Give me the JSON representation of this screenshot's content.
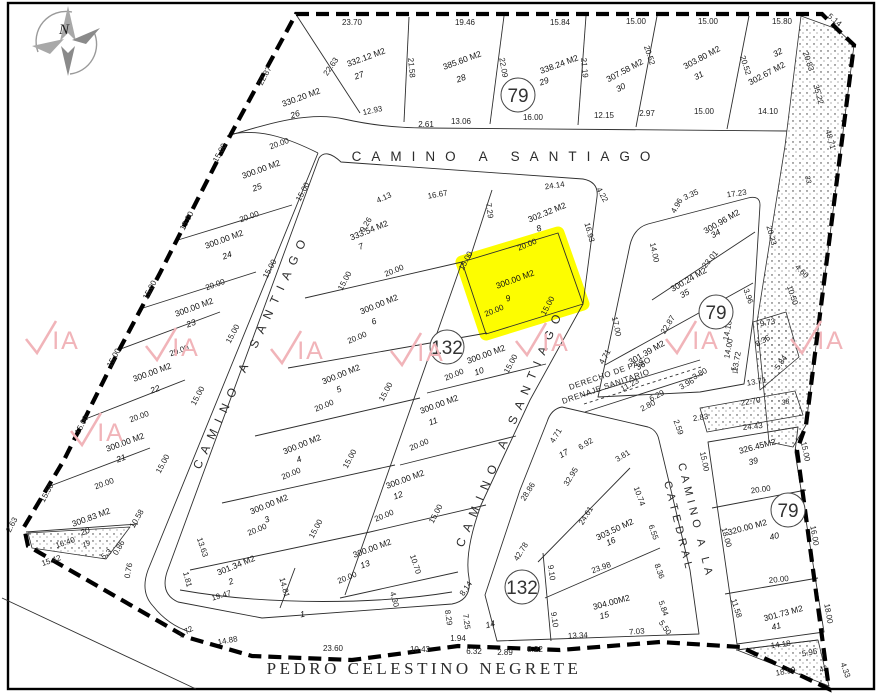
{
  "map": {
    "compass": {
      "label": "N"
    },
    "highlight": {
      "lot": "9",
      "color": "#fdfd00"
    },
    "watermark": {
      "text": "IA",
      "color": "#f1b4b9",
      "positions": [
        [
          50,
          345
        ],
        [
          170,
          352
        ],
        [
          295,
          355
        ],
        [
          415,
          357
        ],
        [
          540,
          347
        ],
        [
          690,
          345
        ],
        [
          815,
          345
        ],
        [
          95,
          437
        ]
      ]
    },
    "streets": [
      {
        "label": "CAMINO A SANTIAGO",
        "x": 506,
        "y": 161,
        "rot": 0,
        "fs": 13.5,
        "ls": 10,
        "anchor": "middle",
        "serif": false
      },
      {
        "label": "CAMINO A SANTIAGO",
        "x": 200,
        "y": 470,
        "rot": -65,
        "fs": 12,
        "ls": 8,
        "anchor": "start",
        "serif": false
      },
      {
        "label": "CAMINO A SANTIAGO",
        "x": 463,
        "y": 548,
        "rot": -67,
        "fs": 12,
        "ls": 8,
        "anchor": "start",
        "serif": false
      },
      {
        "label": "CAMINO A LA",
        "x": 678,
        "y": 464,
        "rot": 76,
        "fs": 11,
        "ls": 4.5,
        "anchor": "start",
        "serif": false
      },
      {
        "label": "CATEDRAL",
        "x": 664,
        "y": 482,
        "rot": 76,
        "fs": 11,
        "ls": 4.5,
        "anchor": "start",
        "serif": false
      },
      {
        "label": "PEDRO CELESTINO NEGRETE",
        "x": 424,
        "y": 674,
        "rot": 0,
        "fs": 17,
        "ls": 3.5,
        "anchor": "middle",
        "serif": true
      }
    ],
    "easement": {
      "line1": "DERECHO DE PASO",
      "line2": "DRENAJE SANITARIO",
      "x": 570,
      "y": 390,
      "x2": 563,
      "y2": 404,
      "rot": -19
    },
    "circles": [
      {
        "label": "79",
        "x": 518,
        "y": 95
      },
      {
        "label": "79",
        "x": 716,
        "y": 312
      },
      {
        "label": "79",
        "x": 788,
        "y": 510
      },
      {
        "label": "132",
        "x": 447,
        "y": 347
      },
      {
        "label": "132",
        "x": 522,
        "y": 587
      }
    ],
    "lots": [
      {
        "n": "26",
        "a": "330.20 M2",
        "ax": 302,
        "ay": 100,
        "nx": 296,
        "ny": 117,
        "r": -20
      },
      {
        "n": "27",
        "a": "332.12 M2",
        "ax": 367,
        "ay": 60,
        "nx": 360,
        "ny": 78,
        "r": -20
      },
      {
        "n": "28",
        "a": "385.60 M2",
        "ax": 463,
        "ay": 63,
        "nx": 462,
        "ny": 81,
        "r": -20
      },
      {
        "n": "29",
        "a": "338.24 M2",
        "ax": 560,
        "ay": 67,
        "nx": 545,
        "ny": 84,
        "r": -20
      },
      {
        "n": "30",
        "a": "307.58 M2",
        "ax": 626,
        "ay": 73,
        "nx": 622,
        "ny": 90,
        "r": -28
      },
      {
        "n": "31",
        "a": "303.80 M2",
        "ax": 703,
        "ay": 60,
        "nx": 700,
        "ny": 78,
        "r": -28
      },
      {
        "n": "32",
        "a": "302.67 M2",
        "ax": 768,
        "ay": 76,
        "nx": 779,
        "ny": 55,
        "r": -28
      },
      {
        "n": "25",
        "a": "300.00 M2",
        "ax": 262,
        "ay": 172,
        "nx": 258,
        "ny": 190,
        "r": -20
      },
      {
        "n": "24",
        "a": "300.00 M2",
        "ax": 225,
        "ay": 242,
        "nx": 228,
        "ny": 258,
        "r": -20
      },
      {
        "n": "23",
        "a": "300.00 M2",
        "ax": 195,
        "ay": 310,
        "nx": 192,
        "ny": 326,
        "r": -20
      },
      {
        "n": "22",
        "a": "300.00 M2",
        "ax": 153,
        "ay": 375,
        "nx": 156,
        "ny": 392,
        "r": -20
      },
      {
        "n": "21",
        "a": "300.00 M2",
        "ax": 126,
        "ay": 445,
        "nx": 122,
        "ny": 461,
        "r": -20
      },
      {
        "n": "20",
        "a": "300.83 M2",
        "ax": 92,
        "ay": 520,
        "nx": 86,
        "ny": 534,
        "r": -20
      },
      {
        "n": "7",
        "a": "333.54 M2",
        "ax": 370,
        "ay": 233,
        "nx": 362,
        "ny": 249,
        "r": -22
      },
      {
        "n": "8",
        "a": "302.32 M2",
        "ax": 548,
        "ay": 215,
        "nx": 540,
        "ny": 231,
        "r": -22
      },
      {
        "n": "9",
        "a": "300.00 M2",
        "ax": 516,
        "ay": 282,
        "nx": 509,
        "ny": 301,
        "r": -20
      },
      {
        "n": "6",
        "a": "300.00 M2",
        "ax": 380,
        "ay": 307,
        "nx": 375,
        "ny": 324,
        "r": -22
      },
      {
        "n": "5",
        "a": "300.00 M2",
        "ax": 342,
        "ay": 377,
        "nx": 340,
        "ny": 392,
        "r": -22
      },
      {
        "n": "4",
        "a": "300.00 M2",
        "ax": 303,
        "ay": 447,
        "nx": 300,
        "ny": 462,
        "r": -22
      },
      {
        "n": "3",
        "a": "300.00 M2",
        "ax": 270,
        "ay": 507,
        "nx": 268,
        "ny": 522,
        "r": -22
      },
      {
        "n": "2",
        "a": "301.34 M2",
        "ax": 237,
        "ay": 568,
        "nx": 232,
        "ny": 584,
        "r": -22
      },
      {
        "n": "1",
        "a": null,
        "nx": 303,
        "ny": 617,
        "r": -10
      },
      {
        "n": "10",
        "a": "300.00 M2",
        "ax": 487,
        "ay": 357,
        "nx": 480,
        "ny": 374,
        "r": -20
      },
      {
        "n": "11",
        "a": "300.00 M2",
        "ax": 440,
        "ay": 407,
        "nx": 434,
        "ny": 424,
        "r": -20
      },
      {
        "n": "12",
        "a": "300.00 M2",
        "ax": 406,
        "ay": 482,
        "nx": 399,
        "ny": 498,
        "r": -20
      },
      {
        "n": "13",
        "a": "300.00 M2",
        "ax": 373,
        "ay": 551,
        "nx": 366,
        "ny": 567,
        "r": -20
      },
      {
        "n": "14",
        "a": null,
        "nx": 491,
        "ny": 627,
        "r": -15
      },
      {
        "n": "15",
        "a": "304.00M2",
        "ax": 612,
        "ay": 605,
        "nx": 605,
        "ny": 618,
        "r": -15
      },
      {
        "n": "16",
        "a": "303.50 M2",
        "ax": 616,
        "ay": 532,
        "nx": 612,
        "ny": 544,
        "r": -25
      },
      {
        "n": "17",
        "a": null,
        "nx": 565,
        "ny": 456,
        "r": -30
      },
      {
        "n": "34",
        "a": "300.96 M2",
        "ax": 723,
        "ay": 224,
        "nx": 717,
        "ny": 236,
        "r": -30
      },
      {
        "n": "35",
        "a": "300.24 M2",
        "ax": 690,
        "ay": 282,
        "nx": 686,
        "ny": 296,
        "r": -30
      },
      {
        "n": "36",
        "a": "301.39 M2",
        "ax": 648,
        "ay": 355,
        "nx": 642,
        "ny": 368,
        "r": -30
      },
      {
        "n": "39",
        "a": "326.45M2",
        "ax": 758,
        "ay": 449,
        "nx": 754,
        "ny": 464,
        "r": -15
      },
      {
        "n": "40",
        "a": "320.00 M2",
        "ax": 748,
        "ay": 530,
        "nx": 775,
        "ny": 539,
        "r": -15
      },
      {
        "n": "41",
        "a": "301.73 M2",
        "ax": 784,
        "ay": 616,
        "nx": 777,
        "ny": 629,
        "r": -15
      },
      {
        "n": "33",
        "a": null,
        "nx": 806,
        "ny": 180,
        "r": 75,
        "s": 1
      },
      {
        "n": "37",
        "a": null,
        "nx": 732,
        "ny": 371,
        "r": 70,
        "s": 1
      },
      {
        "n": "38",
        "a": null,
        "nx": 786,
        "ny": 404,
        "r": -15,
        "s": 1
      },
      {
        "n": "42",
        "a": null,
        "nx": 824,
        "ny": 671,
        "r": -20,
        "s": 1
      },
      {
        "n": "19",
        "a": null,
        "nx": 87,
        "ny": 546,
        "r": -20,
        "s": 1
      }
    ],
    "dims": [
      [
        "23.70",
        352,
        25,
        0
      ],
      [
        "19.46",
        465,
        25,
        0
      ],
      [
        "15.84",
        560,
        25,
        0
      ],
      [
        "15.00",
        636,
        24,
        0
      ],
      [
        "15.00",
        708,
        24,
        0
      ],
      [
        "15.80",
        782,
        24,
        0
      ],
      [
        "5.14",
        833,
        22,
        40
      ],
      [
        "22.87",
        267,
        77,
        -62
      ],
      [
        "22.63",
        333,
        68,
        -55
      ],
      [
        "21.58",
        409,
        68,
        85
      ],
      [
        "22.09",
        501,
        68,
        80
      ],
      [
        "21.19",
        582,
        68,
        85
      ],
      [
        "20.52",
        647,
        56,
        72
      ],
      [
        "20.52",
        743,
        66,
        72
      ],
      [
        "20.83",
        806,
        62,
        72
      ],
      [
        "35.22",
        816,
        95,
        75
      ],
      [
        "48.71",
        828,
        140,
        75
      ],
      [
        "12.93",
        373,
        113,
        -12
      ],
      [
        "2.61",
        426,
        127,
        0
      ],
      [
        "13.06",
        461,
        124,
        0
      ],
      [
        "16.00",
        533,
        120,
        0
      ],
      [
        "12.15",
        604,
        118,
        0
      ],
      [
        "2.97",
        647,
        116,
        0
      ],
      [
        "15.00",
        704,
        114,
        0
      ],
      [
        "14.10",
        768,
        114,
        0
      ],
      [
        "15.00",
        222,
        154,
        -62
      ],
      [
        "15.00",
        189,
        222,
        -62
      ],
      [
        "15.00",
        152,
        291,
        -62
      ],
      [
        "15.00",
        116,
        359,
        -62
      ],
      [
        "15.00",
        84,
        426,
        -62
      ],
      [
        "15.50",
        49,
        494,
        -62
      ],
      [
        "2.63",
        14,
        526,
        -62
      ],
      [
        "16.40",
        66,
        545,
        -18
      ],
      [
        "15.42",
        52,
        563,
        -18
      ],
      [
        "10.58",
        139,
        520,
        -60
      ],
      [
        "5.3",
        108,
        556,
        -40
      ],
      [
        "0.86",
        121,
        549,
        -60
      ],
      [
        "0.76",
        131,
        571,
        -80
      ],
      [
        "1.72",
        187,
        634,
        -30
      ],
      [
        "14.88",
        228,
        643,
        -10
      ],
      [
        "23.60",
        333,
        651,
        0
      ],
      [
        "10.43",
        420,
        652,
        0
      ],
      [
        "1.94",
        458,
        641,
        0
      ],
      [
        "6.32",
        474,
        654,
        0
      ],
      [
        "2.89",
        505,
        655,
        0
      ],
      [
        "8.22",
        535,
        652,
        0
      ],
      [
        "13.34",
        578,
        638,
        -3
      ],
      [
        "7.03",
        637,
        634,
        -5
      ],
      [
        "20.00",
        280,
        146,
        -20
      ],
      [
        "20.00",
        250,
        219,
        -20
      ],
      [
        "20.00",
        216,
        287,
        -20
      ],
      [
        "20.00",
        180,
        353,
        -20
      ],
      [
        "20.00",
        140,
        419,
        -20
      ],
      [
        "20.00",
        105,
        486,
        -20
      ],
      [
        "15.00",
        305,
        193,
        -62
      ],
      [
        "15.00",
        272,
        270,
        -62
      ],
      [
        "15.00",
        235,
        335,
        -62
      ],
      [
        "15.00",
        200,
        397,
        -62
      ],
      [
        "15.00",
        165,
        465,
        -62
      ],
      [
        "20.00",
        395,
        273,
        -22
      ],
      [
        "20.00",
        358,
        340,
        -22
      ],
      [
        "20.00",
        325,
        408,
        -22
      ],
      [
        "20.00",
        292,
        476,
        -22
      ],
      [
        "20.00",
        258,
        532,
        -22
      ],
      [
        "19.47",
        222,
        598,
        -15
      ],
      [
        "14.81",
        282,
        588,
        75
      ],
      [
        "13.63",
        200,
        548,
        72
      ],
      [
        "1.81",
        185,
        580,
        75
      ],
      [
        "20.00",
        528,
        247,
        -22
      ],
      [
        "20.00",
        495,
        313,
        -22
      ],
      [
        "20.00",
        455,
        377,
        -22
      ],
      [
        "20.00",
        420,
        447,
        -22
      ],
      [
        "20.00",
        385,
        518,
        -22
      ],
      [
        "20.00",
        348,
        580,
        -22
      ],
      [
        "15.00",
        347,
        282,
        -62
      ],
      [
        "15.00",
        388,
        393,
        -62
      ],
      [
        "15.00",
        352,
        460,
        -62
      ],
      [
        "15.00",
        318,
        530,
        -62
      ],
      [
        "15.00",
        468,
        262,
        -62
      ],
      [
        "15.00",
        513,
        365,
        -62
      ],
      [
        "15.00",
        438,
        515,
        -62
      ],
      [
        "15.00",
        550,
        307,
        -62
      ],
      [
        "10.70",
        413,
        565,
        72
      ],
      [
        "4.30",
        392,
        600,
        75
      ],
      [
        "4.13",
        385,
        200,
        -25
      ],
      [
        "16.67",
        438,
        197,
        -10
      ],
      [
        "9.26",
        368,
        226,
        -58
      ],
      [
        "7.29",
        487,
        211,
        82
      ],
      [
        "24.14",
        555,
        188,
        -8
      ],
      [
        "4.22",
        600,
        196,
        60
      ],
      [
        "16.93",
        587,
        233,
        75
      ],
      [
        "17.00",
        614,
        327,
        78
      ],
      [
        "14.00",
        652,
        253,
        78
      ],
      [
        "4.96",
        679,
        207,
        -60
      ],
      [
        "3.35",
        692,
        197,
        -25
      ],
      [
        "17.23",
        737,
        196,
        -8
      ],
      [
        "20.23",
        769,
        236,
        75
      ],
      [
        "23.01",
        712,
        261,
        -50
      ],
      [
        "3.96",
        746,
        297,
        70
      ],
      [
        "22.87",
        670,
        326,
        -58
      ],
      [
        "9.73",
        768,
        325,
        -10
      ],
      [
        "8.36",
        764,
        343,
        -30
      ],
      [
        "5.84",
        783,
        364,
        -55
      ],
      [
        "13.71",
        757,
        384,
        -10
      ],
      [
        "14.18",
        730,
        331,
        -80
      ],
      [
        "14.00",
        731,
        349,
        -80
      ],
      [
        "13.72",
        739,
        362,
        -80
      ],
      [
        "11.23",
        631,
        387,
        -28
      ],
      [
        "6.29",
        658,
        398,
        -28
      ],
      [
        "2.80",
        649,
        408,
        -28
      ],
      [
        "3.96",
        688,
        386,
        -30
      ],
      [
        "3.80",
        701,
        376,
        -30
      ],
      [
        "2.59",
        676,
        428,
        70
      ],
      [
        "2.83",
        701,
        420,
        -8
      ],
      [
        "15.00",
        702,
        462,
        78
      ],
      [
        "4.71",
        607,
        358,
        -60
      ],
      [
        "10.50",
        790,
        296,
        72
      ],
      [
        "4.60",
        800,
        273,
        45
      ],
      [
        "4.71",
        558,
        437,
        -58
      ],
      [
        "6.92",
        587,
        446,
        -32
      ],
      [
        "3.81",
        624,
        458,
        -32
      ],
      [
        "32.95",
        573,
        478,
        -58
      ],
      [
        "28.86",
        530,
        493,
        -58
      ],
      [
        "24.61",
        588,
        517,
        -58
      ],
      [
        "10.74",
        637,
        497,
        70
      ],
      [
        "6.55",
        651,
        533,
        70
      ],
      [
        "8.36",
        657,
        572,
        70
      ],
      [
        "5.84",
        661,
        609,
        70
      ],
      [
        "5.50",
        663,
        629,
        55
      ],
      [
        "23.98",
        602,
        570,
        -20
      ],
      [
        "42.78",
        523,
        553,
        -58
      ],
      [
        "9.10",
        549,
        573,
        82
      ],
      [
        "9.10",
        552,
        620,
        82
      ],
      [
        "8.14",
        468,
        590,
        -55
      ],
      [
        "8.29",
        446,
        618,
        82
      ],
      [
        "7.25",
        464,
        622,
        82
      ],
      [
        "22.70",
        751,
        404,
        -10
      ],
      [
        "24.43",
        753,
        429,
        -6
      ],
      [
        "15.00",
        803,
        452,
        78
      ],
      [
        "20.00",
        761,
        492,
        -8
      ],
      [
        "16.00",
        812,
        536,
        80
      ],
      [
        "18.00",
        724,
        538,
        74
      ],
      [
        "20.00",
        779,
        582,
        -6
      ],
      [
        "18.00",
        826,
        614,
        80
      ],
      [
        "11.58",
        734,
        609,
        72
      ],
      [
        "14.18",
        781,
        647,
        -8
      ],
      [
        "5.95",
        810,
        655,
        -10
      ],
      [
        "18.99",
        786,
        674,
        -10
      ],
      [
        "4.33",
        843,
        671,
        70
      ]
    ]
  }
}
